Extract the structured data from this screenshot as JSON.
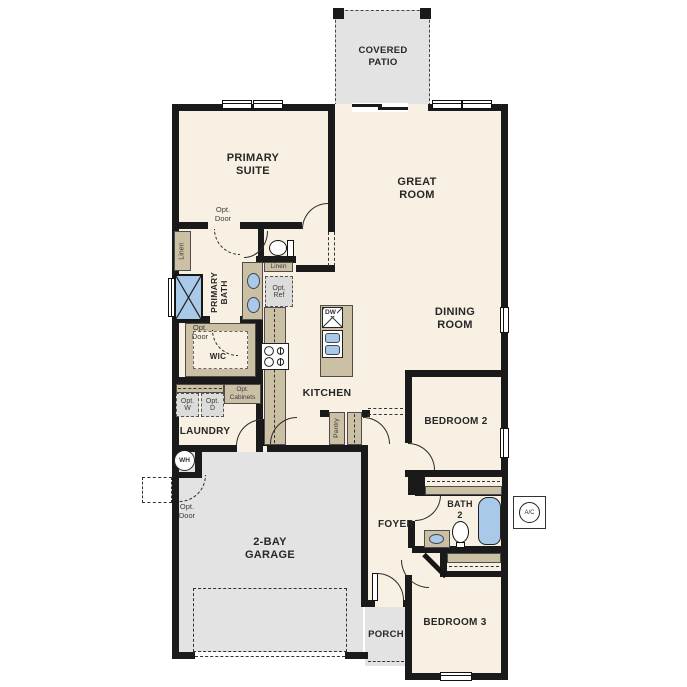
{
  "plan_title": "Single story floor plan",
  "labels": {
    "covered_patio": {
      "lines": [
        "COVERED",
        "PATIO"
      ]
    },
    "primary_suite": {
      "lines": [
        "PRIMARY",
        "SUITE"
      ]
    },
    "great_room": {
      "lines": [
        "GREAT",
        "ROOM"
      ]
    },
    "dining_room": {
      "lines": [
        "DINING",
        "ROOM"
      ]
    },
    "kitchen": "KITCHEN",
    "laundry": "LAUNDRY",
    "garage": {
      "lines": [
        "2-BAY",
        "GARAGE"
      ]
    },
    "foyer": "FOYER",
    "porch": "PORCH",
    "bedroom2": "BEDROOM 2",
    "bedroom3": "BEDROOM 3",
    "bath2": {
      "lines": [
        "BATH",
        "2"
      ]
    },
    "wic": "WIC",
    "primary_bath": {
      "lines": [
        "PRIMARY",
        "BATH"
      ]
    },
    "pantry": "Pantry"
  },
  "annotations": {
    "opt_door_suite": {
      "lines": [
        "Opt.",
        "Door"
      ]
    },
    "opt_door_wic": {
      "lines": [
        "Opt.",
        "Door"
      ]
    },
    "opt_door_garage": {
      "lines": [
        "Opt.",
        "Door"
      ]
    },
    "linen_closet": "Linen",
    "linen_shelf": "Linen",
    "opt_ref": {
      "lines": [
        "Opt.",
        "Ref"
      ]
    },
    "opt_washer": {
      "lines": [
        "Opt.",
        "W"
      ]
    },
    "opt_dryer": {
      "lines": [
        "Opt.",
        "D"
      ]
    },
    "opt_cabinets": {
      "lines": [
        "Opt.",
        "Cabinets"
      ]
    },
    "water_heater": "WH",
    "ac_unit": "A/C",
    "dishwasher": "DW"
  },
  "colors": {
    "floor": "#f7f0e3",
    "concrete_gray": "#e2e3e2",
    "casework_tan": "#cbbfa4",
    "fixture_blue": "#a9c9e9",
    "wall_black": "#1a1a1a",
    "optional_fill": "#dcdddb"
  }
}
